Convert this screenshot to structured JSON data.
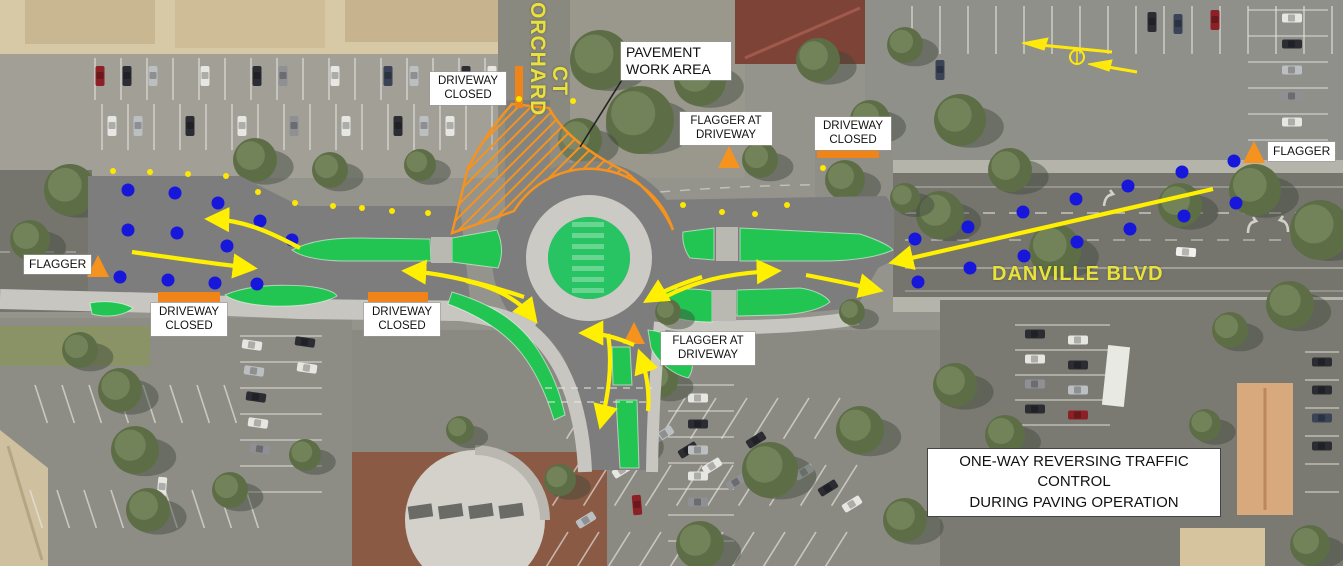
{
  "plan": {
    "labels": {
      "driveway_closed": "DRIVEWAY\nCLOSED",
      "pavement_work_area": "PAVEMENT\nWORK AREA",
      "flagger": "FLAGGER",
      "flagger_at_driveway": "FLAGGER AT\nDRIVEWAY",
      "one_way_note": "ONE-WAY REVERSING TRAFFIC CONTROL\nDURING PAVING OPERATION"
    },
    "road_names": {
      "orchard_line1": "ORCHARD",
      "orchard_line2": "CT",
      "danville": "DANVILLE BLVD"
    },
    "colors": {
      "work_zone_gray": "#7d7d7d",
      "apron_gray": "#cbcac4",
      "island_green": "#22c551",
      "center_island_green": "#28c362",
      "work_area_orange": "#f6921e",
      "closure_bar_orange": "#f08418",
      "arrow_yellow": "#ffef00",
      "delineator_blue": "#1717dc",
      "delineator_yellow": "#ffe800",
      "road_name_yellow": "#e9e23e",
      "label_bg": "#ffffff",
      "label_text": "#111111"
    },
    "markers": {
      "closure_bars": [
        [
          515,
          66,
          8,
          42
        ],
        [
          158,
          292,
          62,
          10
        ],
        [
          368,
          292,
          60,
          10
        ],
        [
          817,
          148,
          62,
          10
        ]
      ],
      "flagger_positions": [
        [
          98,
          266
        ],
        [
          729,
          157
        ],
        [
          634,
          333
        ],
        [
          1254,
          152
        ]
      ],
      "blue_dots": [
        [
          128,
          190
        ],
        [
          175,
          193
        ],
        [
          218,
          203
        ],
        [
          260,
          221
        ],
        [
          292,
          240
        ],
        [
          128,
          230
        ],
        [
          177,
          233
        ],
        [
          227,
          246
        ],
        [
          120,
          277
        ],
        [
          168,
          280
        ],
        [
          215,
          283
        ],
        [
          257,
          284
        ],
        [
          915,
          239
        ],
        [
          968,
          227
        ],
        [
          1023,
          212
        ],
        [
          1076,
          199
        ],
        [
          1128,
          186
        ],
        [
          1182,
          172
        ],
        [
          1234,
          161
        ],
        [
          918,
          282
        ],
        [
          970,
          268
        ],
        [
          1024,
          256
        ],
        [
          1077,
          242
        ],
        [
          1130,
          229
        ],
        [
          1184,
          216
        ],
        [
          1236,
          203
        ]
      ],
      "yellow_dots": [
        [
          113,
          171
        ],
        [
          150,
          172
        ],
        [
          188,
          174
        ],
        [
          226,
          176
        ],
        [
          258,
          192
        ],
        [
          295,
          203
        ],
        [
          333,
          206
        ],
        [
          362,
          208
        ],
        [
          392,
          211
        ],
        [
          428,
          213
        ],
        [
          519,
          99
        ],
        [
          573,
          101
        ],
        [
          683,
          205
        ],
        [
          722,
          212
        ],
        [
          755,
          214
        ],
        [
          787,
          205
        ],
        [
          823,
          168
        ]
      ]
    },
    "flow_arrows": [
      "M 300 248 C 268 231 243 220 210 219",
      "M 132 252 C 175 258 215 264 252 268",
      "M 524 297 C 482 283 442 273 407 271",
      "M 466 281 C 498 288 520 301 534 319",
      "M 608 334 C 613 366 608 396 601 424",
      "M 648 411 C 650 390 646 371 640 354",
      "M 634 345 C 616 337 600 333 584 333",
      "M 702 277 C 683 283 663 291 648 300",
      "M 665 297 C 692 283 724 273 776 271",
      "M 806 275 C 832 280 856 285 878 290",
      "M 1213 189 L 894 262"
    ]
  }
}
